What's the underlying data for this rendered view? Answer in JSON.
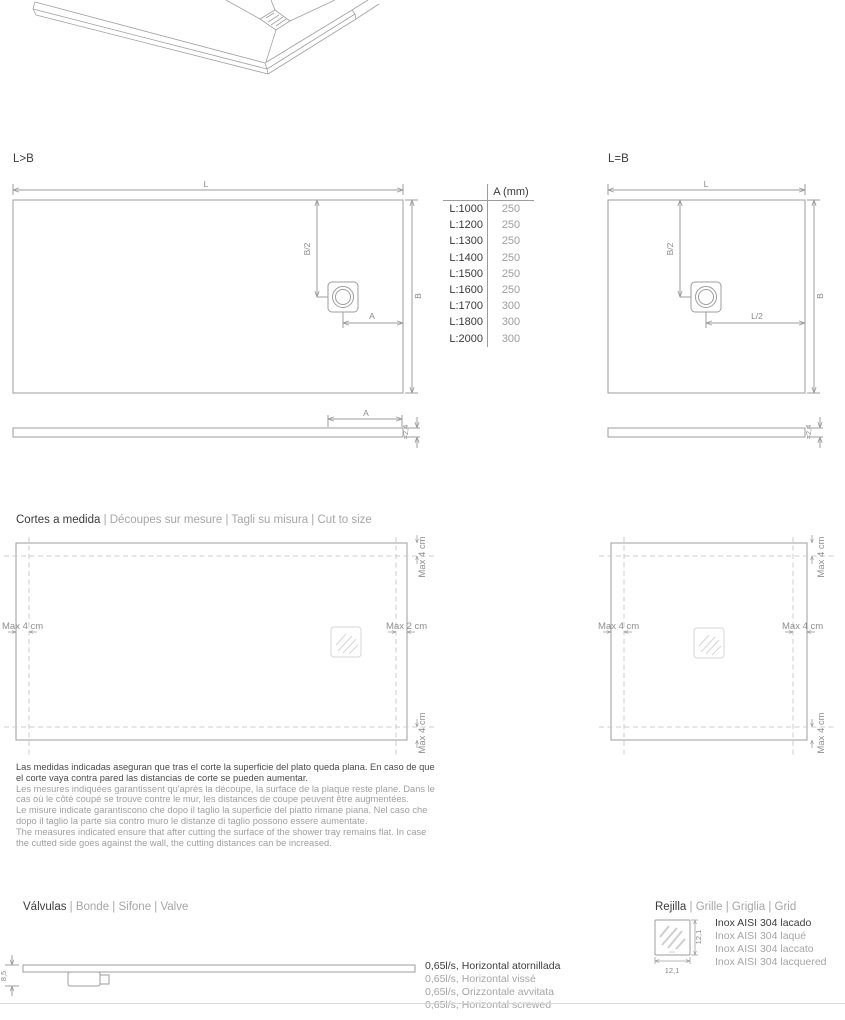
{
  "colors": {
    "line": "#9c9c9c",
    "dark_text": "#3c3c3c",
    "gray_text": "#a6a6a6",
    "dash": "#cccccc"
  },
  "diagrams": {
    "rect": {
      "label": "L>B",
      "dim_l": "L",
      "dim_b": "B",
      "dim_b_half": "B/2",
      "dim_a": "A",
      "profile_dim_a": "A",
      "profile_thickness": "≈2,4"
    },
    "square": {
      "label": "L=B",
      "dim_l": "L",
      "dim_b": "B",
      "dim_b_half": "B/2",
      "dim_l_half": "L/2",
      "profile_thickness": "≈2,4"
    }
  },
  "drain_table": {
    "header": "A (mm)",
    "rows": [
      {
        "label": "L:1000",
        "value": "250"
      },
      {
        "label": "L:1200",
        "value": "250"
      },
      {
        "label": "L:1300",
        "value": "250"
      },
      {
        "label": "L:1400",
        "value": "250"
      },
      {
        "label": "L:1500",
        "value": "250"
      },
      {
        "label": "L:1600",
        "value": "250"
      },
      {
        "label": "L:1700",
        "value": "300"
      },
      {
        "label": "L:1800",
        "value": "300"
      },
      {
        "label": "L:2000",
        "value": "300"
      }
    ]
  },
  "cut_to_size": {
    "title": "Cortes a medida",
    "translations": " | Découpes sur mesure | Tagli su misura | Cut to size",
    "rect_diagram": {
      "top": "Max 4 cm",
      "left": "Max 4 cm",
      "right": "Max 2 cm",
      "bottom": "Max 4 cm"
    },
    "square_diagram": {
      "top": "Max 4 cm",
      "left": "Max 4 cm",
      "right": "Max 4 cm",
      "bottom": "Max 4 cm"
    },
    "notes": {
      "es": "Las medidas indicadas aseguran que tras el corte la superficie del plato queda plana. En caso de que el corte vaya contra pared las distancias de corte se pueden aumentar.",
      "fr": "Les mesures indiquées garantissent qu'après la découpe, la surface de la plaque reste plane. Dans le cas où le côté coupé se trouve contre le mur, les distances de coupe peuvent être augmentées.",
      "it": "Le misure indicate garantiscono che dopo il taglio la superficie del piatto rimane piana. Nel caso che dopo il taglio la parte sia contro muro le distanze di taglio possono essere aumentate.",
      "en": "The measures indicated ensure that after cutting the surface of the shower tray remains flat. In case the cutted side goes against the wall, the cutting distances can be increased."
    }
  },
  "valves": {
    "title": "Válvulas",
    "translations": " | Bonde | Sifone | Valve",
    "height_dim": "8,5",
    "specs": [
      "0,65l/s, Horizontal atornillada",
      "0,65l/s, Horizontal vissé",
      "0,65l/s, Orizzontale avvitata",
      "0,65l/s, Horizontal screwed"
    ]
  },
  "grille": {
    "title": "Rejilla",
    "translations": " | Grille | Griglia | Grid",
    "width_dim": "12,1",
    "height_dim": "12,1",
    "specs": [
      "Inox AISI 304 lacado",
      "Inox AISI 304 laqué",
      "Inox AISI 304 laccato",
      "Inox AISI 304 lacquered"
    ]
  }
}
